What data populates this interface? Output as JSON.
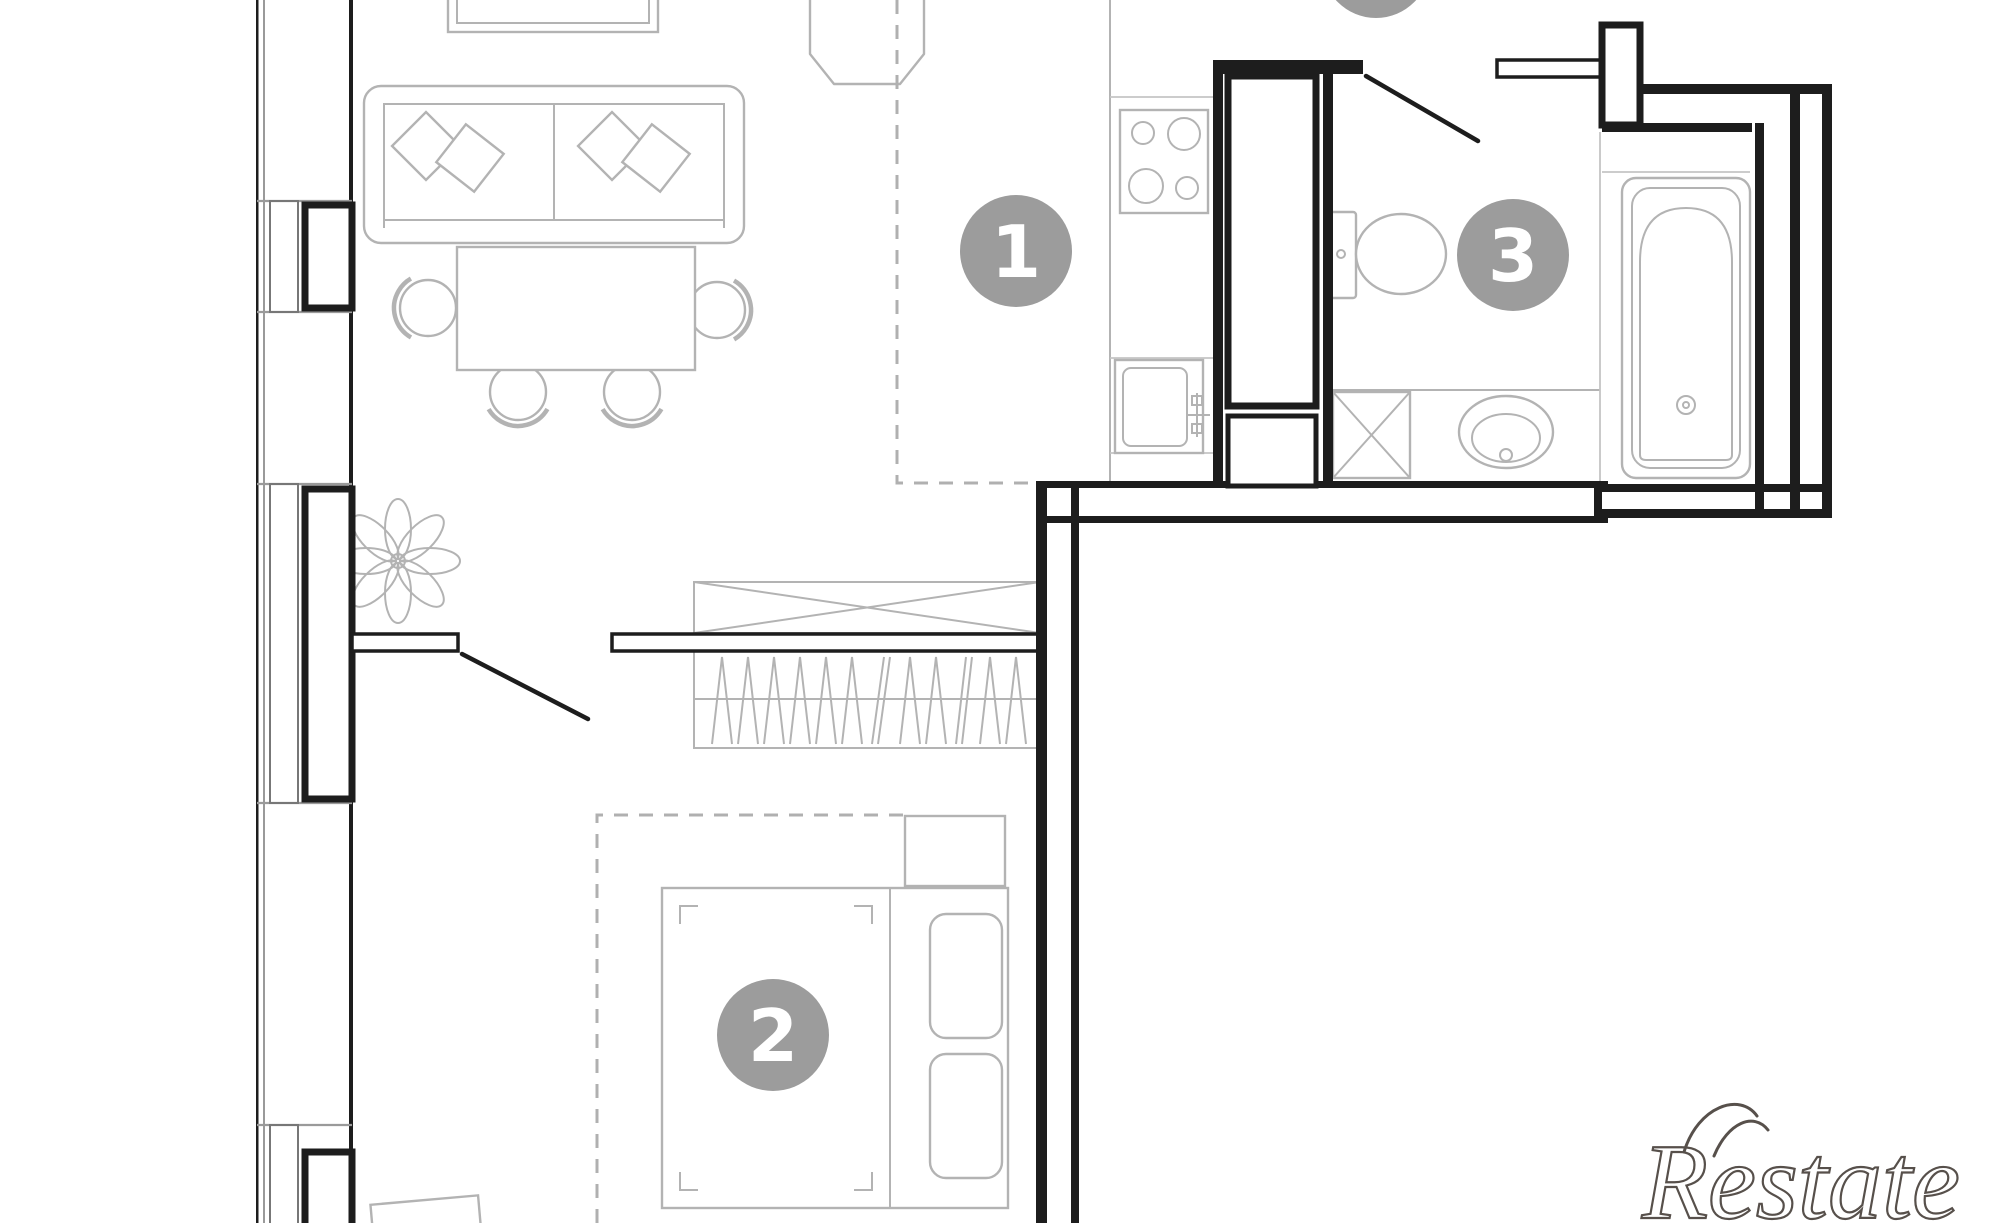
{
  "canvas": {
    "width": 2000,
    "height": 1223
  },
  "rooms": [
    {
      "name": "living-room-kitchen",
      "badge": "1"
    },
    {
      "name": "bedroom",
      "badge": "2"
    },
    {
      "name": "bathroom",
      "badge": "3"
    }
  ],
  "watermark": {
    "text": "Restate"
  },
  "fixtures": [
    "tv-stand",
    "sofa",
    "sofa-pillows",
    "dining-table",
    "dining-chairs",
    "armchair",
    "plant",
    "kitchen-counter",
    "stove-burners",
    "kitchen-sink",
    "tall-cabinets",
    "toilet",
    "washing-machine",
    "bathroom-sink",
    "bathtub",
    "storage-closet",
    "wardrobe-hangers",
    "double-bed",
    "bed-pillows",
    "nightstand",
    "rug-outline",
    "balcony-windows",
    "door-swings"
  ],
  "colors": {
    "background": "#ffffff",
    "walls": "#1d1d1d",
    "furniture": "#b3b3b3",
    "badge": "#9c9c9c",
    "dashed_zone": "#b0b0b0",
    "watermark": "#57504b"
  }
}
